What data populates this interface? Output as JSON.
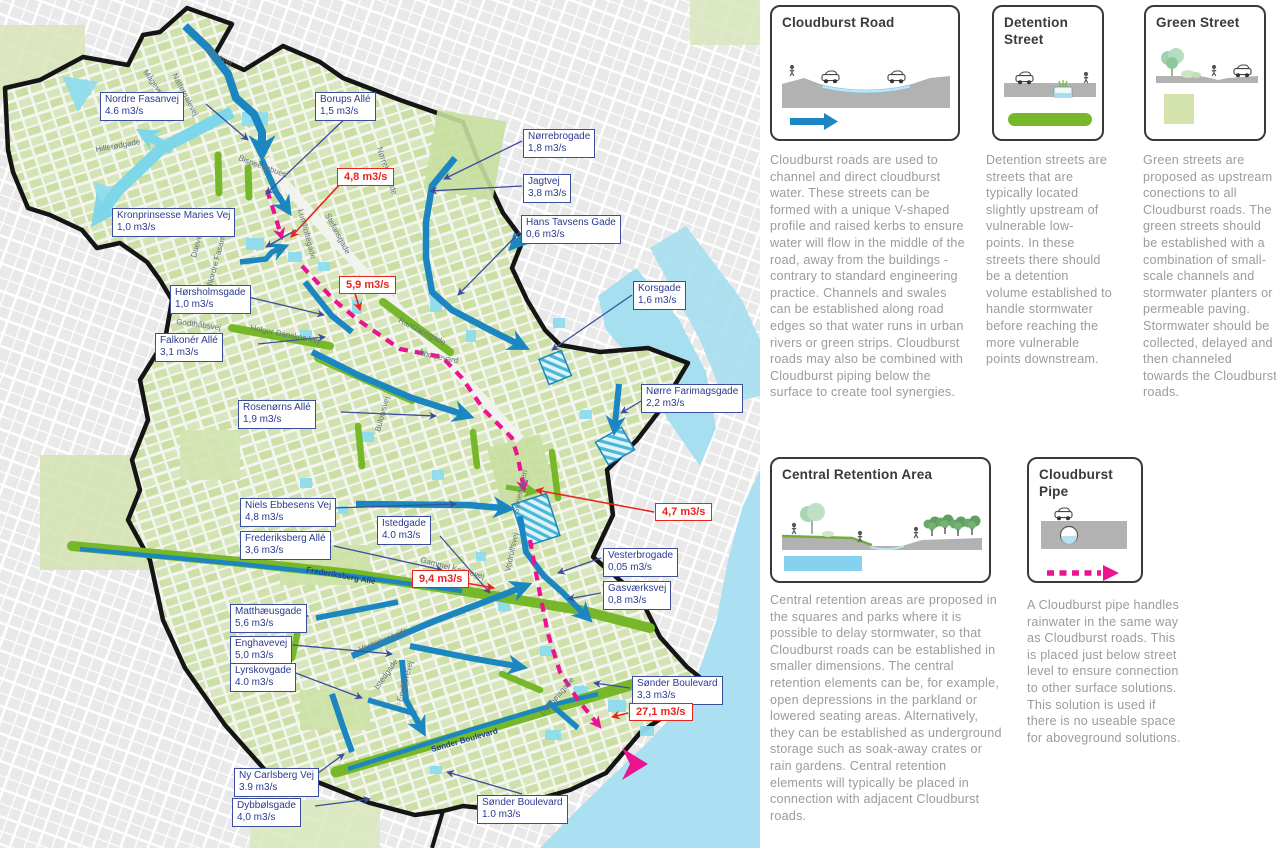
{
  "map": {
    "labels": [
      {
        "street": "Nordre Fasanvej",
        "value": "4.6 m3/s"
      },
      {
        "street": "Kronprinsesse Maries Vej",
        "value": "1,0 m3/s"
      },
      {
        "street": "Borups Allé",
        "value": "1,5 m3/s"
      },
      {
        "street": "Nørrebrogade",
        "value": "1,8 m3/s"
      },
      {
        "street": "Jagtvej",
        "value": "3,8 m3/s"
      },
      {
        "street": "Hans Tavsens Gade",
        "value": "0,6 m3/s"
      },
      {
        "street": "Korsgade",
        "value": "1,6 m3/s"
      },
      {
        "street": "Hørsholmsgade",
        "value": "1,0 m3/s"
      },
      {
        "street": "Falkonér Allé",
        "value": "3,1 m3/s"
      },
      {
        "street": "Nørre Farimagsgade",
        "value": "2,2 m3/s"
      },
      {
        "street": "Rosenørns Allé",
        "value": "1,9 m3/s"
      },
      {
        "street": "Niels Ebbesens Vej",
        "value": "4,8 m3/s"
      },
      {
        "street": "Istedgade",
        "value": "4.0 m3/s"
      },
      {
        "street": "Frederiksberg Allé",
        "value": "3,6 m3/s"
      },
      {
        "street": "Vesterbrogade",
        "value": "0,05 m3/s"
      },
      {
        "street": "Gasværksvej",
        "value": "0,8 m3/s"
      },
      {
        "street": "Matthæusgade",
        "value": "5,6 m3/s"
      },
      {
        "street": "Enghavevej",
        "value": "5,0 m3/s"
      },
      {
        "street": "Lyrskovgade",
        "value": "4.0 m3/s"
      },
      {
        "street": "Sønder Boulevard",
        "value": "3,3 m3/s"
      },
      {
        "street": "Ny Carlsberg Vej",
        "value": "3.9 m3/s"
      },
      {
        "street": "Dybbølsgade",
        "value": "4,0 m3/s"
      },
      {
        "street": "Sønder Boulevard",
        "value": "1.0 m3/s"
      }
    ],
    "flow_callouts": [
      {
        "value": "4,8 m3/s"
      },
      {
        "value": "5,9 m3/s"
      },
      {
        "value": "4,7 m3/s"
      },
      {
        "value": "9,4 m3/s"
      },
      {
        "value": "27,1 m3/s"
      }
    ],
    "street_names": [
      "Hillerødgade",
      "Nattergalevej",
      "Ørnevej",
      "Mågevej",
      "Bispeengbuen",
      "Lundtoftegade",
      "Stefansgade",
      "Nørrebrogade",
      "Rantzausgade",
      "Åboulevard",
      "Godthåbsvej",
      "Holger Danskes Vej",
      "Bülowsvej",
      "Gammel Kongevej",
      "Vesterbrogade",
      "Enghavevej",
      "Frederiksberg Allé",
      "Istedgade",
      "Sønder Boulevard",
      "Dybbølsgade",
      "Vodroffsvej",
      "Svineryggen",
      "Nordre Fasanvej",
      "Duevej"
    ],
    "colors": {
      "cloudburst_road": "#1b86c0",
      "green_street": "#76b82a",
      "cloudburst_pipe": "#ec1390",
      "water": "#a5dff0",
      "label_blue": "#2b3a8f",
      "callout_red": "#e8241d"
    }
  },
  "legend_cards": [
    {
      "title": "Cloudburst Road",
      "description": "Cloudburst roads are used to channel and direct cloudburst water. These streets can be formed with a unique V-shaped profile and raised kerbs to ensure water will flow in the middle of the road, away from the buildings - contrary to standard engineering practice. Channels and swales can be established along road edges so that water runs in urban rivers or green strips. Cloudburst roads may also be combined with Cloudburst piping below the surface to create tool synergies."
    },
    {
      "title": "Detention Street",
      "description": "Detention streets are streets that are typically located slightly upstream of vulnerable low-points. In these streets there should be a detention volume established to handle stormwater before reaching the more vulnerable points downstream."
    },
    {
      "title": "Green Street",
      "description": "Green streets are proposed as upstream conections to all Cloudburst roads. The green streets should be established with a combination of small-scale channels and stormwater planters or permeable paving. Stormwater should be collected, delayed and then channeled towards the Cloudburst roads."
    },
    {
      "title": "Central Retention Area",
      "description": "Central retention areas are proposed in the squares and parks where it is possible to delay stormwater, so that Cloudburst roads can be established in smaller dimensions. The central retention elements can be, for example, open depressions in the parkland or lowered seating areas. Alternatively, they can be established as underground storage such as soak-away crates or rain gardens. Central retention elements will typically be placed in connection with adjacent Cloudburst roads."
    },
    {
      "title": "Cloudburst Pipe",
      "description": "A Cloudburst pipe handles rainwater in the same way as Cloudburst roads. This is placed just below street level to ensure connection to other surface solutions. This solution is used if there is no useable space for aboveground solutions."
    }
  ]
}
